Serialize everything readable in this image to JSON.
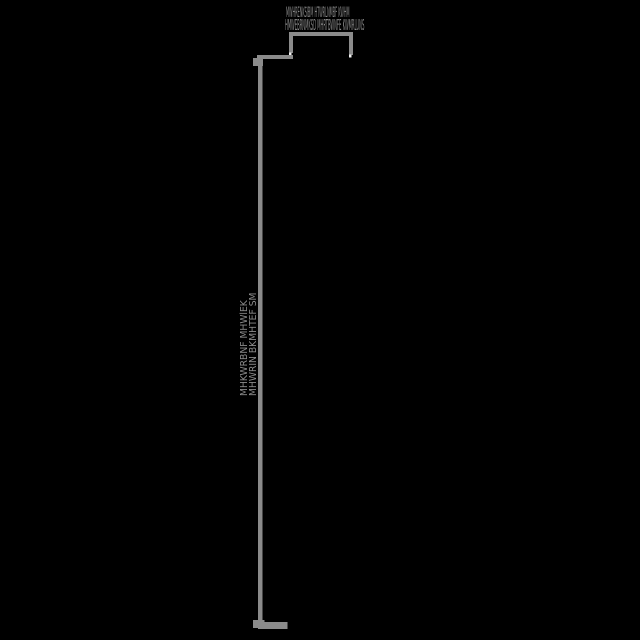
{
  "palette": {
    "background": "#000000",
    "line": "#8b8b8b",
    "text": "#8b8b8b",
    "endpoint_dot": "#f2f2f2"
  },
  "title": {
    "line1": "MWHRENKSIBM HTWRLNMBF KWHM",
    "line2": "HMWEBRNMKSD MHRTBWNFE KWMRLUNS"
  },
  "y_axis_label": {
    "line_outer": "MHKWRBNF    MHWlEK",
    "line_inner": "MHWRIN BKMHTEF SM"
  },
  "chart_data": {
    "type": "line",
    "title": "illegible (horizontally compressed, 2 lines)",
    "ylabel": "illegible (rotated 90°, compressed, 2 lines)",
    "xlabel": "",
    "legend": "none",
    "grid": false,
    "series": [
      {
        "name": "gray-outline-path",
        "points_px": [
          [
            351,
            56
          ],
          [
            351,
            34
          ],
          [
            291,
            34
          ],
          [
            291,
            52
          ],
          [
            291,
            57
          ],
          [
            259,
            57
          ],
          [
            260,
            57
          ],
          [
            260,
            624
          ],
          [
            287,
            624
          ]
        ]
      }
    ],
    "endpoint_markers_px": [
      [
        290,
        53
      ],
      [
        350,
        55
      ]
    ],
    "tick_blobs_px": [
      [
        258,
        62
      ],
      [
        258,
        624
      ]
    ],
    "axis_line_px": {
      "x": 260,
      "y_top": 55,
      "y_bottom": 626
    }
  }
}
